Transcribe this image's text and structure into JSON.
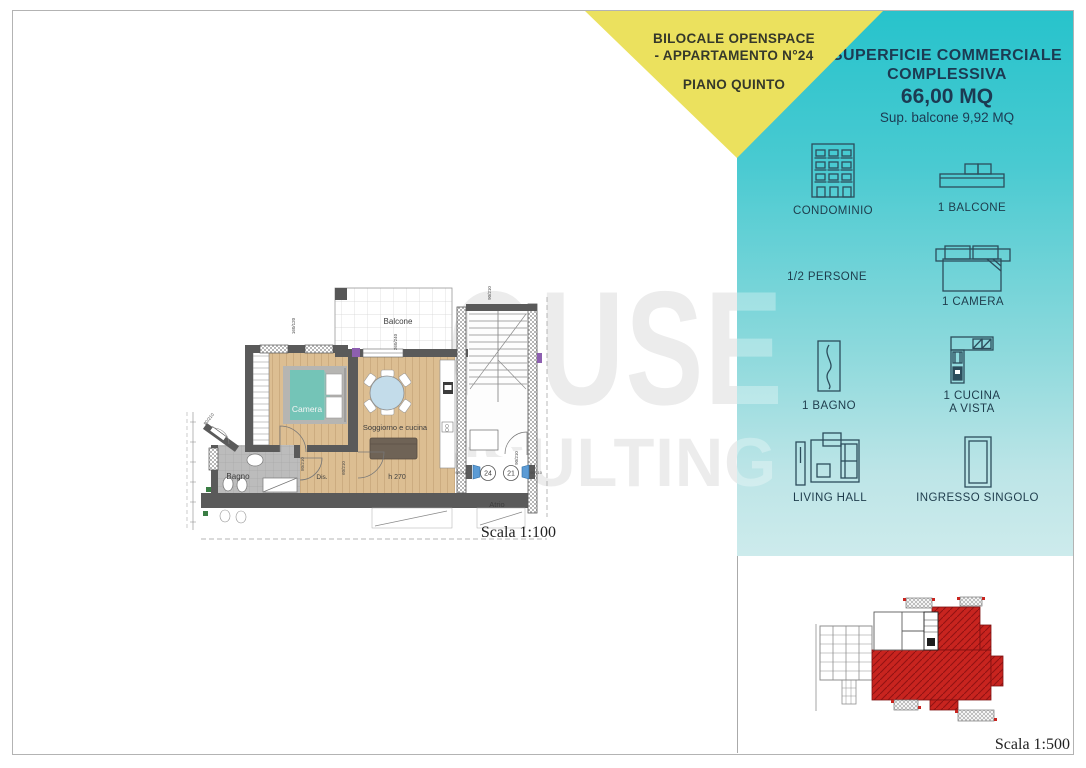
{
  "banner": {
    "line1": "BILOCALE OPENSPACE",
    "line2": "- APPARTAMENTO N°24",
    "line3": "PIANO QUINTO"
  },
  "panel": {
    "title_line1": "SUPERFICIE COMMERCIALE",
    "title_line2": "COMPLESSIVA",
    "area_value": "66,00 MQ",
    "balcony_area": "Sup. balcone 9,92  MQ",
    "features": [
      {
        "icon": "building-icon",
        "label": "CONDOMINIO",
        "label2": ""
      },
      {
        "icon": "balcony-icon",
        "label": "1 BALCONE",
        "label2": ""
      },
      {
        "icon": "persons-icon",
        "label": "1/2 PERSONE",
        "label2": ""
      },
      {
        "icon": "bed-icon",
        "label": "1 CAMERA",
        "label2": ""
      },
      {
        "icon": "bathtub-icon",
        "label": "1 BAGNO",
        "label2": ""
      },
      {
        "icon": "kitchen-icon",
        "label": "1 CUCINA",
        "label2": "A VISTA"
      },
      {
        "icon": "sofa-icon",
        "label": "LIVING HALL",
        "label2": ""
      },
      {
        "icon": "door-icon",
        "label": "INGRESSO SINGOLO",
        "label2": ""
      }
    ]
  },
  "floorplan": {
    "rooms": {
      "balcone": "Balcone",
      "camera": "Camera",
      "soggiorno": "Soggiorno e cucina",
      "bagno": "Bagno",
      "dis": "Dis.",
      "atrio": "Atrio"
    },
    "height_label": "h 270",
    "apartment_numbers": [
      "24",
      "21"
    ],
    "dims": {
      "camera_window": "160/120",
      "balcone_size": "260/240",
      "stair_door": "90/210",
      "camera_door": "80/210",
      "sogg_door": "60/210",
      "entry_left": "90/210",
      "entry_mid": "90/210",
      "entry_right": "90/210",
      "entry_diag": "80/210"
    },
    "scale_label": "Scala 1:100"
  },
  "siteplan": {
    "scale_label": "Scala 1:500"
  },
  "watermark": {
    "line1": "HOUSE",
    "line2": "CONSULTING"
  },
  "colors": {
    "teal_top": "#27c3cc",
    "teal_bottom": "#cdebec",
    "yellow": "#ebe15e",
    "title_text": "#1c3a52",
    "red_building": "#c8241f",
    "wood_floor": "#dcbe92"
  }
}
